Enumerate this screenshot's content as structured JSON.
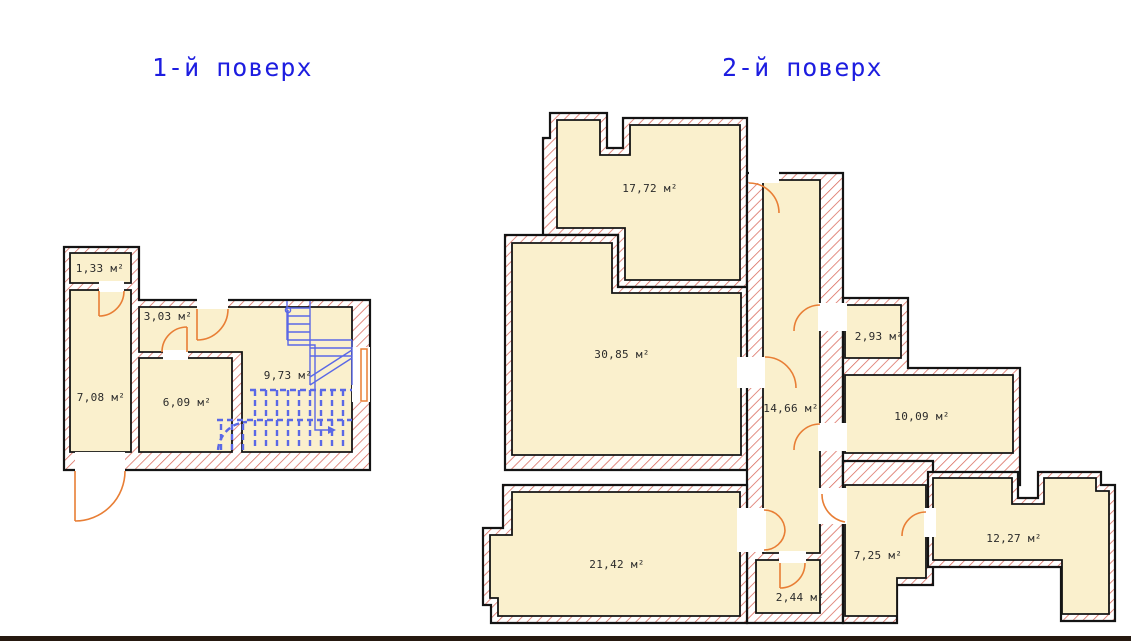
{
  "floor1": {
    "title": "1-й поверх",
    "rooms": [
      {
        "label": "1,33 м²"
      },
      {
        "label": "3,03 м²"
      },
      {
        "label": "7,08 м²"
      },
      {
        "label": "6,09 м²"
      },
      {
        "label": "9,73 м²"
      }
    ]
  },
  "floor2": {
    "title": "2-й поверх",
    "rooms": [
      {
        "label": "17,72 м²"
      },
      {
        "label": "30,85 м²"
      },
      {
        "label": "14,66 м²"
      },
      {
        "label": "2,93 м²"
      },
      {
        "label": "10,09 м²"
      },
      {
        "label": "21,42 м²"
      },
      {
        "label": "2,44 м²"
      },
      {
        "label": "7,25 м²"
      },
      {
        "label": "12,27 м²"
      }
    ]
  },
  "colors": {
    "room_fill": "#faf0cd",
    "wall_hatch": "#d9685a",
    "door": "#e87e35",
    "stairs": "#5a68e6",
    "title": "#1d1de0",
    "outline": "#141414",
    "bottom_bar": "#261910"
  }
}
